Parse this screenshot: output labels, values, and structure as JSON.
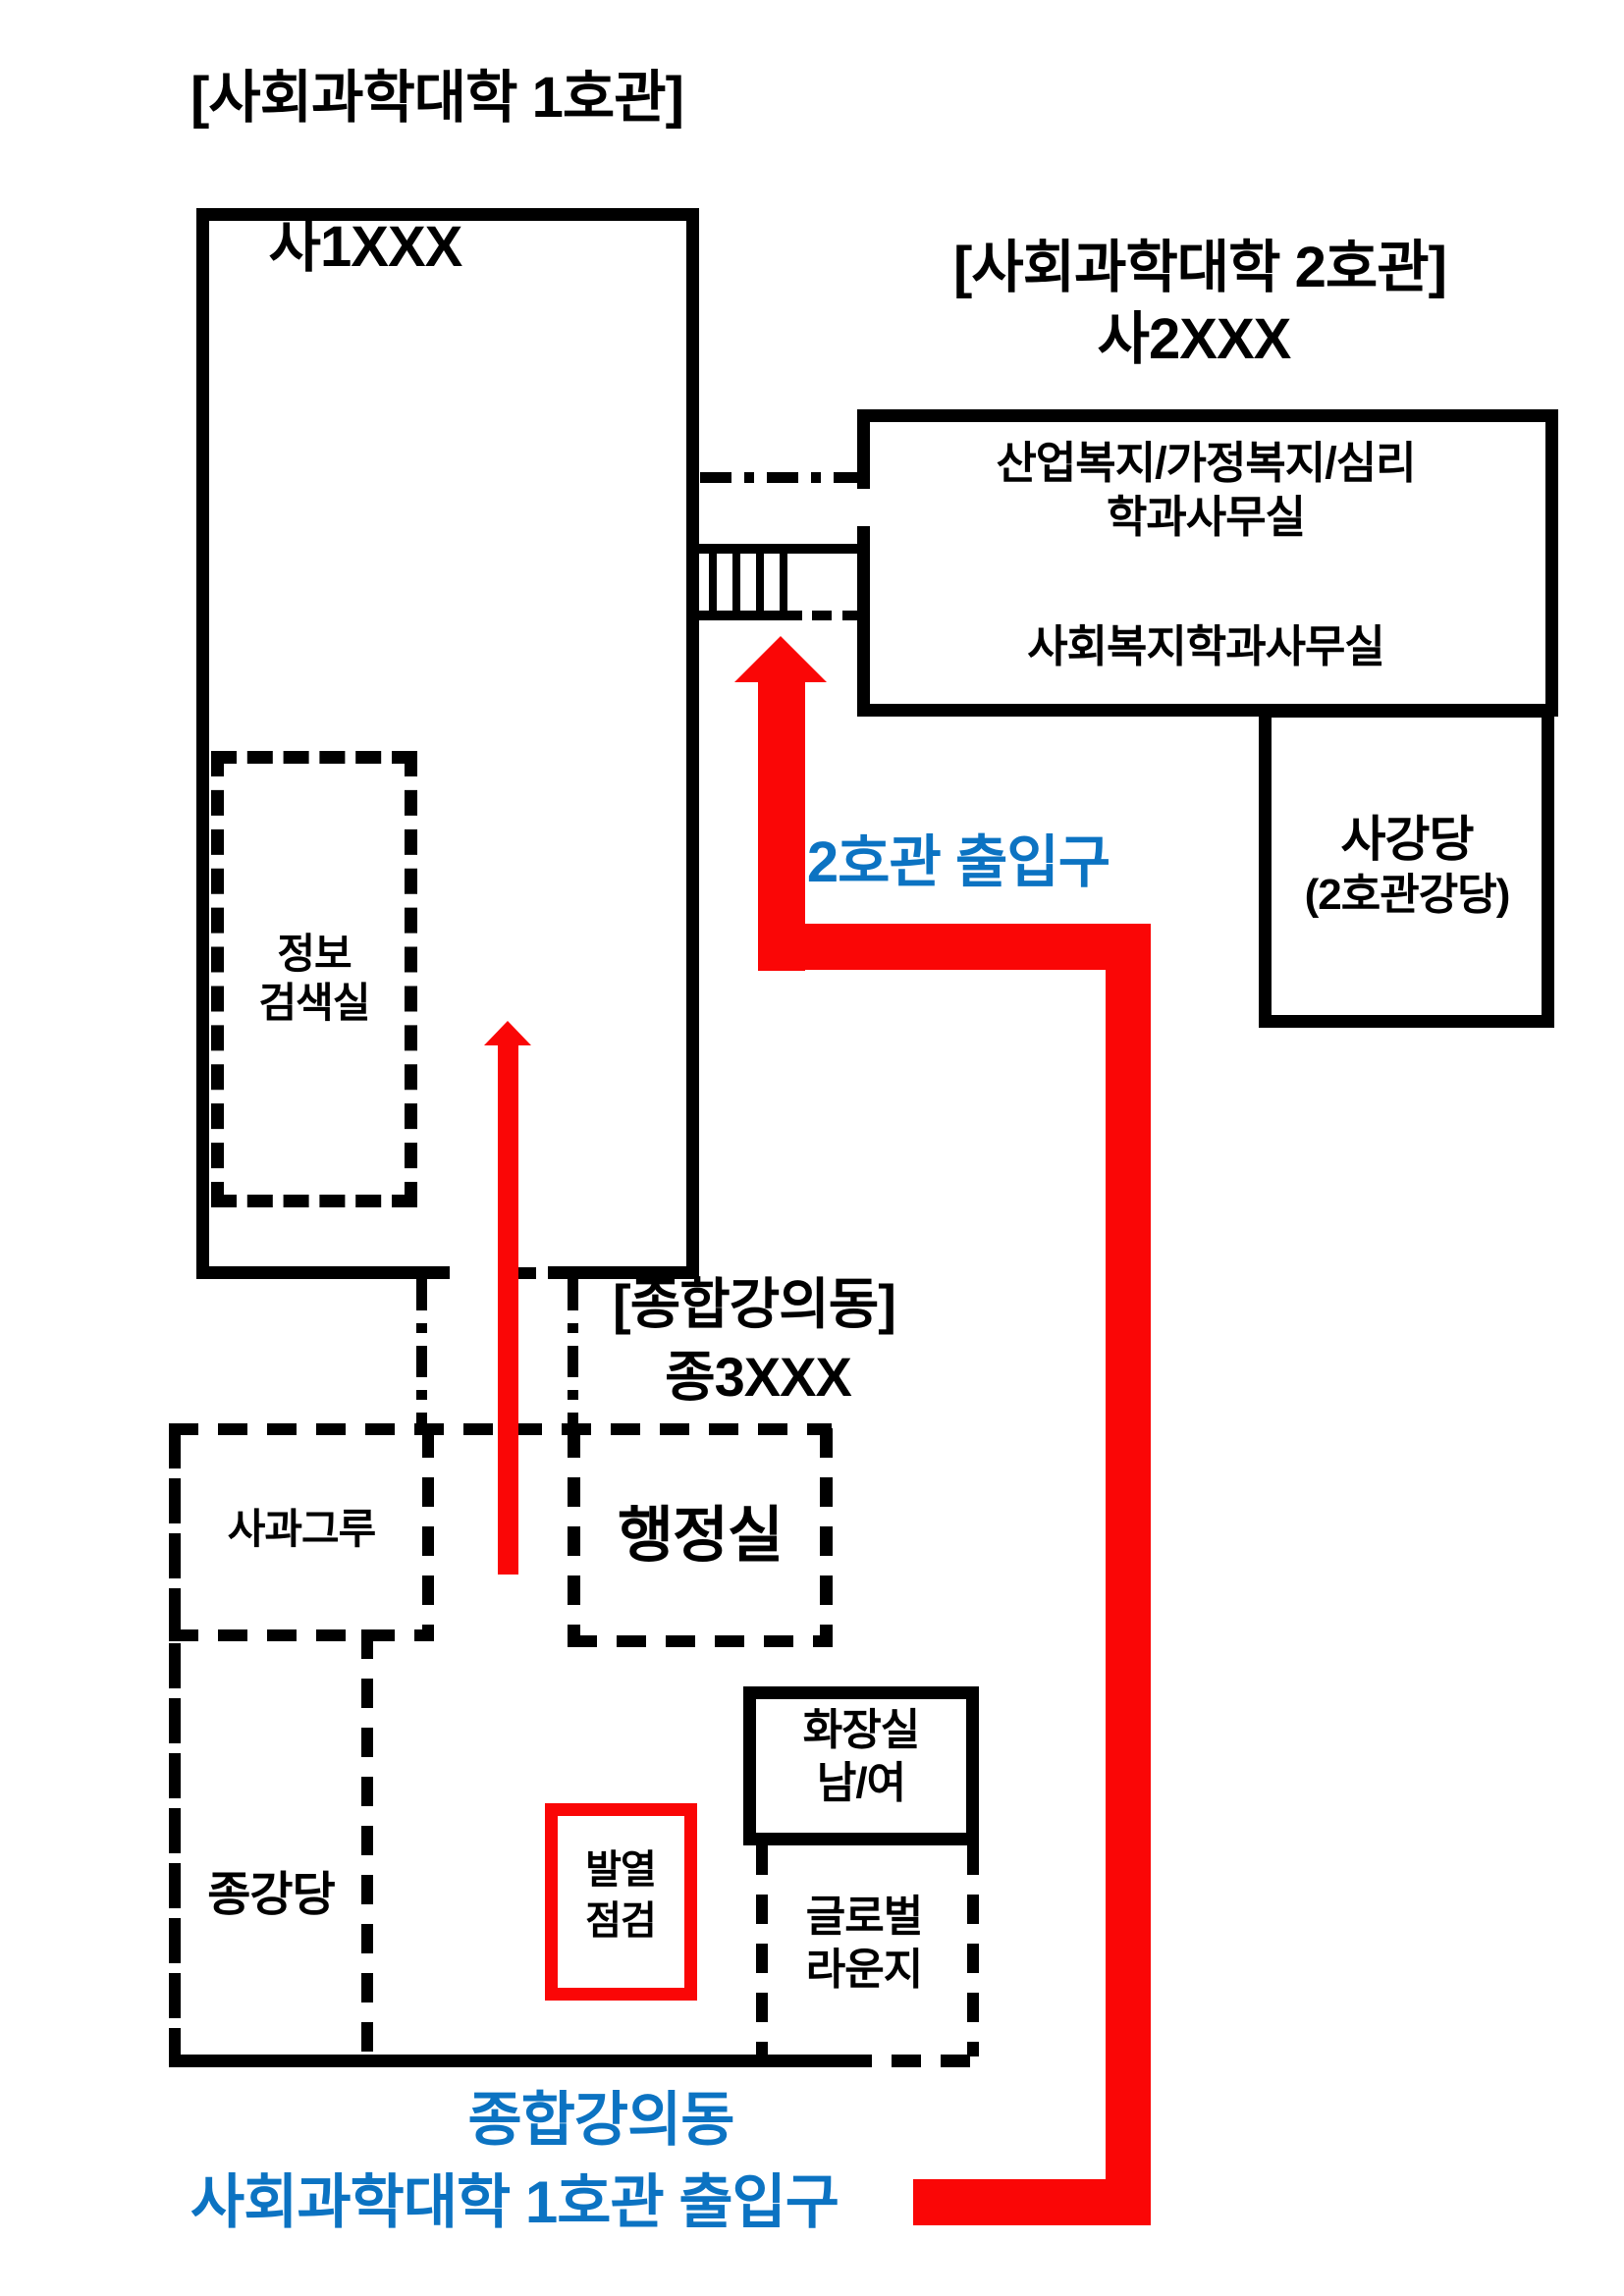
{
  "colors": {
    "route_red": "#fa0606",
    "entrance_blue": "#0c73c2",
    "line_black": "#000000"
  },
  "building1": {
    "title": "[사회과학대학 1호관]",
    "code": "사1XXX",
    "info_room_line1": "정보",
    "info_room_line2": "검색실"
  },
  "building2": {
    "title": "[사회과학대학 2호관]",
    "code": "사2XXX",
    "dept_office_line1": "산업복지/가정복지/심리",
    "dept_office_line2": "학과사무실",
    "welfare_dept_office": "사회복지학과사무실",
    "auditorium_name": "사강당",
    "auditorium_alias": "(2호관강당)",
    "entrance_label": "2호관 출입구"
  },
  "lecture_building": {
    "title": "[종합강의동]",
    "code": "종3XXX",
    "admin_office": "행정실",
    "study_room": "사과그루",
    "auditorium": "종강당",
    "restroom_line1": "화장실",
    "restroom_line2": "남/여",
    "fever_check_line1": "발열",
    "fever_check_line2": "점검",
    "global_lounge_line1": "글로벌",
    "global_lounge_line2": "라운지"
  },
  "footer": {
    "entrance_line1": "종합강의동",
    "entrance_line2": "사회과학대학 1호관 출입구"
  }
}
